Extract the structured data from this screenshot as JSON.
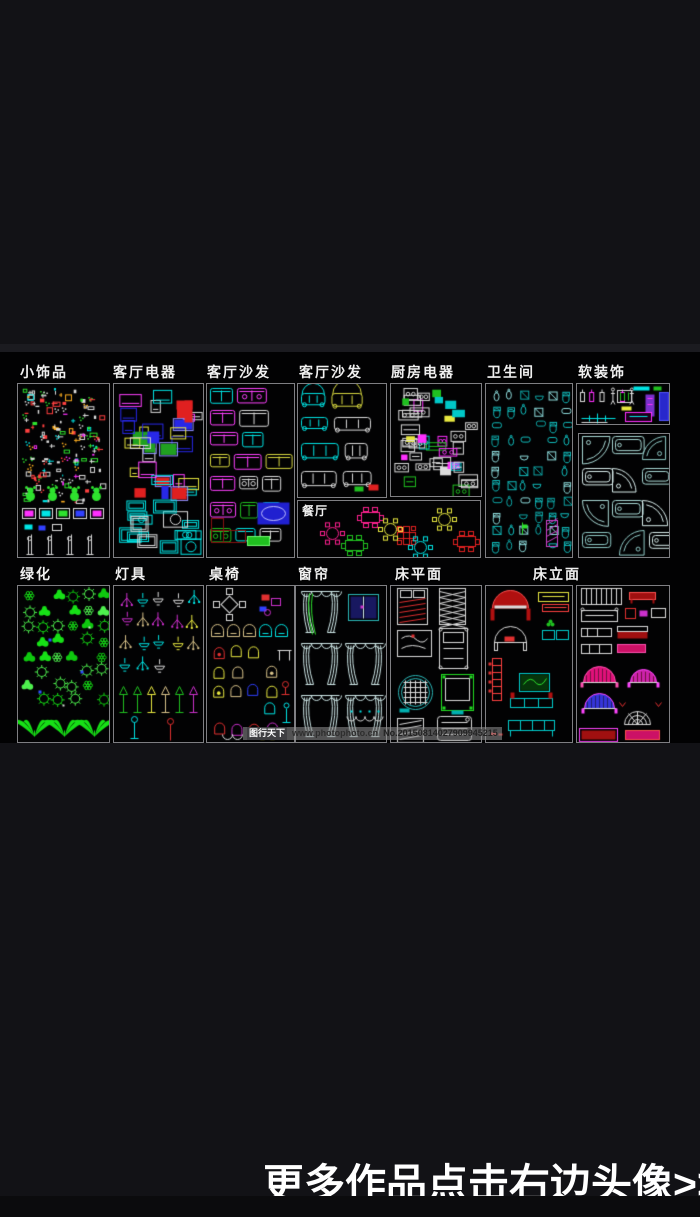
{
  "page": {
    "bg": "#121216",
    "strip": {
      "top": 352,
      "height": 391,
      "bg": "#020203",
      "panel_border": "#7e7e82",
      "label_color": "#f0f0f0"
    }
  },
  "headline": {
    "text": "更多作品点击右边头像>>",
    "color": "#ffffff"
  },
  "watermark": {
    "brand": "图行天下",
    "site": "www.photophoto.cn",
    "serial": "No.20150814027909945215"
  },
  "panels": [
    {
      "id": "trinkets",
      "label": "小饰品",
      "label_x": 20,
      "x": 17,
      "y": 383,
      "w": 93,
      "h": 175,
      "border": true,
      "motif": "trinkets",
      "palette": [
        "#dcdcdc",
        "#ff4040",
        "#2ee22e",
        "#00e5e5",
        "#ff30ff",
        "#ffb020",
        "#3040ff"
      ]
    },
    {
      "id": "living-appliances",
      "label": "客厅电器",
      "label_x": 113,
      "x": 113,
      "y": 383,
      "w": 91,
      "h": 175,
      "border": true,
      "motif": "appliances",
      "palette": [
        "#2828e8",
        "#e02020",
        "#00e5e5",
        "#dcdcdc",
        "#20a020",
        "#e8e840",
        "#9090ff"
      ]
    },
    {
      "id": "sofa-plan",
      "label": "客厅沙发",
      "label_x": 207,
      "x": 206,
      "y": 383,
      "w": 89,
      "h": 175,
      "border": true,
      "motif": "sofaPlan",
      "palette": [
        "#00e5e5",
        "#ff40ff",
        "#d8d840",
        "#20c020",
        "#dcdcdc",
        "#2020d0",
        "#8a1010"
      ]
    },
    {
      "id": "sofa-elev",
      "label": "客厅沙发",
      "label_x": 299,
      "x": 297,
      "y": 383,
      "w": 90,
      "h": 115,
      "border": true,
      "motif": "sofaElev",
      "palette": [
        "#dcdcdc",
        "#00e5e5",
        "#d8d840",
        "#e02020",
        "#20c020"
      ]
    },
    {
      "id": "kitchen-appliances",
      "label": "厨房电器",
      "label_x": 391,
      "x": 390,
      "y": 383,
      "w": 92,
      "h": 114,
      "border": true,
      "motif": "kitchen",
      "palette": [
        "#dcdcdc",
        "#20c020",
        "#ff30ff",
        "#e8e840",
        "#00c8c8"
      ]
    },
    {
      "id": "dining",
      "label": "餐厅",
      "label_inside": true,
      "x": 297,
      "y": 500,
      "w": 184,
      "h": 58,
      "border": true,
      "motif": "dining",
      "palette": [
        "#ff2090",
        "#e8e840",
        "#20c020",
        "#3040ff",
        "#e02020",
        "#00e5e5",
        "#ff30ff"
      ]
    },
    {
      "id": "bathroom",
      "label": "卫生间",
      "label_x": 487,
      "x": 485,
      "y": 383,
      "w": 88,
      "h": 175,
      "border": true,
      "motif": "bathroom",
      "palette": [
        "#12bdbd",
        "#0fa5a5",
        "#8fdede",
        "#cc44cc",
        "#2ee22e",
        "#dcdcdc"
      ]
    },
    {
      "id": "soft-decor",
      "label": "软装饰",
      "label_x": 578,
      "x": 576,
      "y": 383,
      "w": 94,
      "h": 42,
      "border": true,
      "motif": "softdecor",
      "palette": [
        "#dcdcdc",
        "#ff30ff",
        "#00e5e5",
        "#2828cc",
        "#7a30cc",
        "#e8e840",
        "#20c020"
      ]
    },
    {
      "id": "bathtubs",
      "label": "",
      "x": 578,
      "y": 433,
      "w": 92,
      "h": 125,
      "border": true,
      "motif": "tubs",
      "palette": [
        "#a8d8d4",
        "#d8eceb",
        "#8fcac6"
      ]
    },
    {
      "id": "greenery",
      "label": "绿化",
      "label_x": 20,
      "x": 17,
      "y": 585,
      "w": 93,
      "h": 158,
      "border": true,
      "motif": "plants",
      "palette": [
        "#17e017",
        "#0fc80f",
        "#4ef04e",
        "#3050ff",
        "#dcdcdc"
      ]
    },
    {
      "id": "lamps",
      "label": "灯具",
      "label_x": 115,
      "x": 113,
      "y": 585,
      "w": 91,
      "h": 158,
      "border": true,
      "motif": "lamps",
      "palette": [
        "#d9c38a",
        "#00e5e5",
        "#20c020",
        "#dcdcdc",
        "#cc30cc",
        "#e8e840",
        "#e03030"
      ]
    },
    {
      "id": "tables-chairs",
      "label": "桌椅",
      "label_x": 209,
      "x": 206,
      "y": 585,
      "w": 89,
      "h": 158,
      "border": true,
      "motif": "chairs",
      "palette": [
        "#e03030",
        "#20c020",
        "#e8e840",
        "#00e5e5",
        "#cc30cc",
        "#3040ff",
        "#d9c38a",
        "#dcdcdc"
      ]
    },
    {
      "id": "curtains",
      "label": "窗帘",
      "label_x": 298,
      "x": 295,
      "y": 585,
      "w": 92,
      "h": 158,
      "border": true,
      "motif": "curtains",
      "palette": [
        "#cfe8e8",
        "#2ee22e",
        "#2bb8b8",
        "#181860",
        "#cc30cc",
        "#dcdcdc",
        "#00e5e5"
      ]
    },
    {
      "id": "bed-plan",
      "label": "床平面",
      "label_x": 395,
      "x": 390,
      "y": 585,
      "w": 92,
      "h": 158,
      "border": true,
      "motif": "bedPlan",
      "palette": [
        "#dcdcdc",
        "#e03030",
        "#2bb8b8",
        "#22dd22",
        "#00b0b0"
      ]
    },
    {
      "id": "bed-elevation-a",
      "label": "床立面",
      "label_x": 533,
      "x": 485,
      "y": 585,
      "w": 88,
      "h": 158,
      "border": true,
      "motif": "bedElevA",
      "palette": [
        "#b01010",
        "#ff5050",
        "#dcdcdc",
        "#e8e840",
        "#ff4040",
        "#00cccc",
        "#20c020",
        "#2ee22e",
        "#e03030",
        "#06350a"
      ]
    },
    {
      "id": "bed-elevation-b",
      "label": "",
      "x": 576,
      "y": 585,
      "w": 94,
      "h": 158,
      "border": true,
      "motif": "bedElevB",
      "palette": [
        "#dcdcdc",
        "#a01010",
        "#ff5050",
        "#cc30cc",
        "#e03030",
        "#cc1166",
        "#ff50b0",
        "#e0107a",
        "#701040",
        "#3535d8",
        "#ff44ff",
        "#cc22aa"
      ]
    }
  ]
}
